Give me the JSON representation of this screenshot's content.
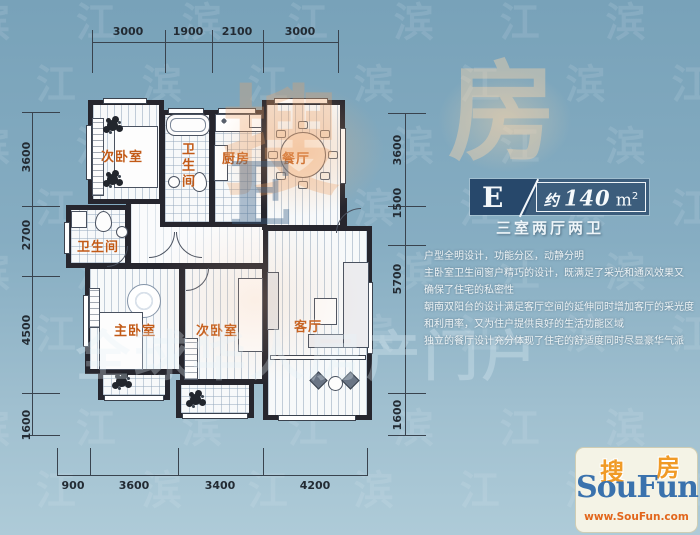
{
  "palette": {
    "background_top": "#78a2b9",
    "background_bottom": "#aecbd8",
    "wall": "#26262e",
    "room_label_orange": "#c25a17",
    "dimension_text": "#232b33",
    "badge_navy": "#27486b",
    "badge_navy_light": "#3c5d7c",
    "text_white": "#f4f8fa",
    "logo_blue": "#3a72ad",
    "logo_orange": "#f09a26",
    "logo_url_red": "#e2661c"
  },
  "dimensions": {
    "top": [
      "3000",
      "1900",
      "2100",
      "3000"
    ],
    "left": [
      "3600",
      "2700",
      "4500",
      "1600"
    ],
    "right": [
      "3600",
      "1500",
      "5700",
      "1600"
    ],
    "bottom": [
      "900",
      "3600",
      "3400",
      "4200"
    ]
  },
  "rooms": {
    "bedroom_top": "次卧室",
    "bathroom_top": "卫生间",
    "kitchen": "厨房",
    "dining": "餐厅",
    "bathroom_mid": "卫生间",
    "master_bedroom": "主卧室",
    "bedroom_bottom": "次卧室",
    "living": "客厅"
  },
  "badge": {
    "unit_letter": "E",
    "approx": "约",
    "area": "140",
    "area_unit": "m",
    "area_sup": "2",
    "layout": "三室两厅两卫"
  },
  "description": {
    "lines": [
      "户型全明设计，功能分区，动静分明",
      "主卧室卫生间窗户精巧的设计，既满足了采光和通风效果又",
      "确保了住宅的私密性",
      "朝南双阳台的设计满足客厅空间的延伸同时增加客厅的采光度",
      "和利用率，又为住户提供良好的生活功能区域",
      "独立的餐厅设计充分体现了住宅的舒适度同时尽显豪华气派"
    ]
  },
  "logo": {
    "cn_first": "搜",
    "cn_second": "房",
    "en_name": "SouFun",
    "url": "www.SouFun.com"
  },
  "watermark": {
    "tile_row": "滨 江 滨 江 滨 江 滨 江 滨 江 滨 江",
    "slogan": "全球华人房产门户",
    "big_cn": "搜",
    "big_cn2": "房",
    "big_letter": "E"
  }
}
